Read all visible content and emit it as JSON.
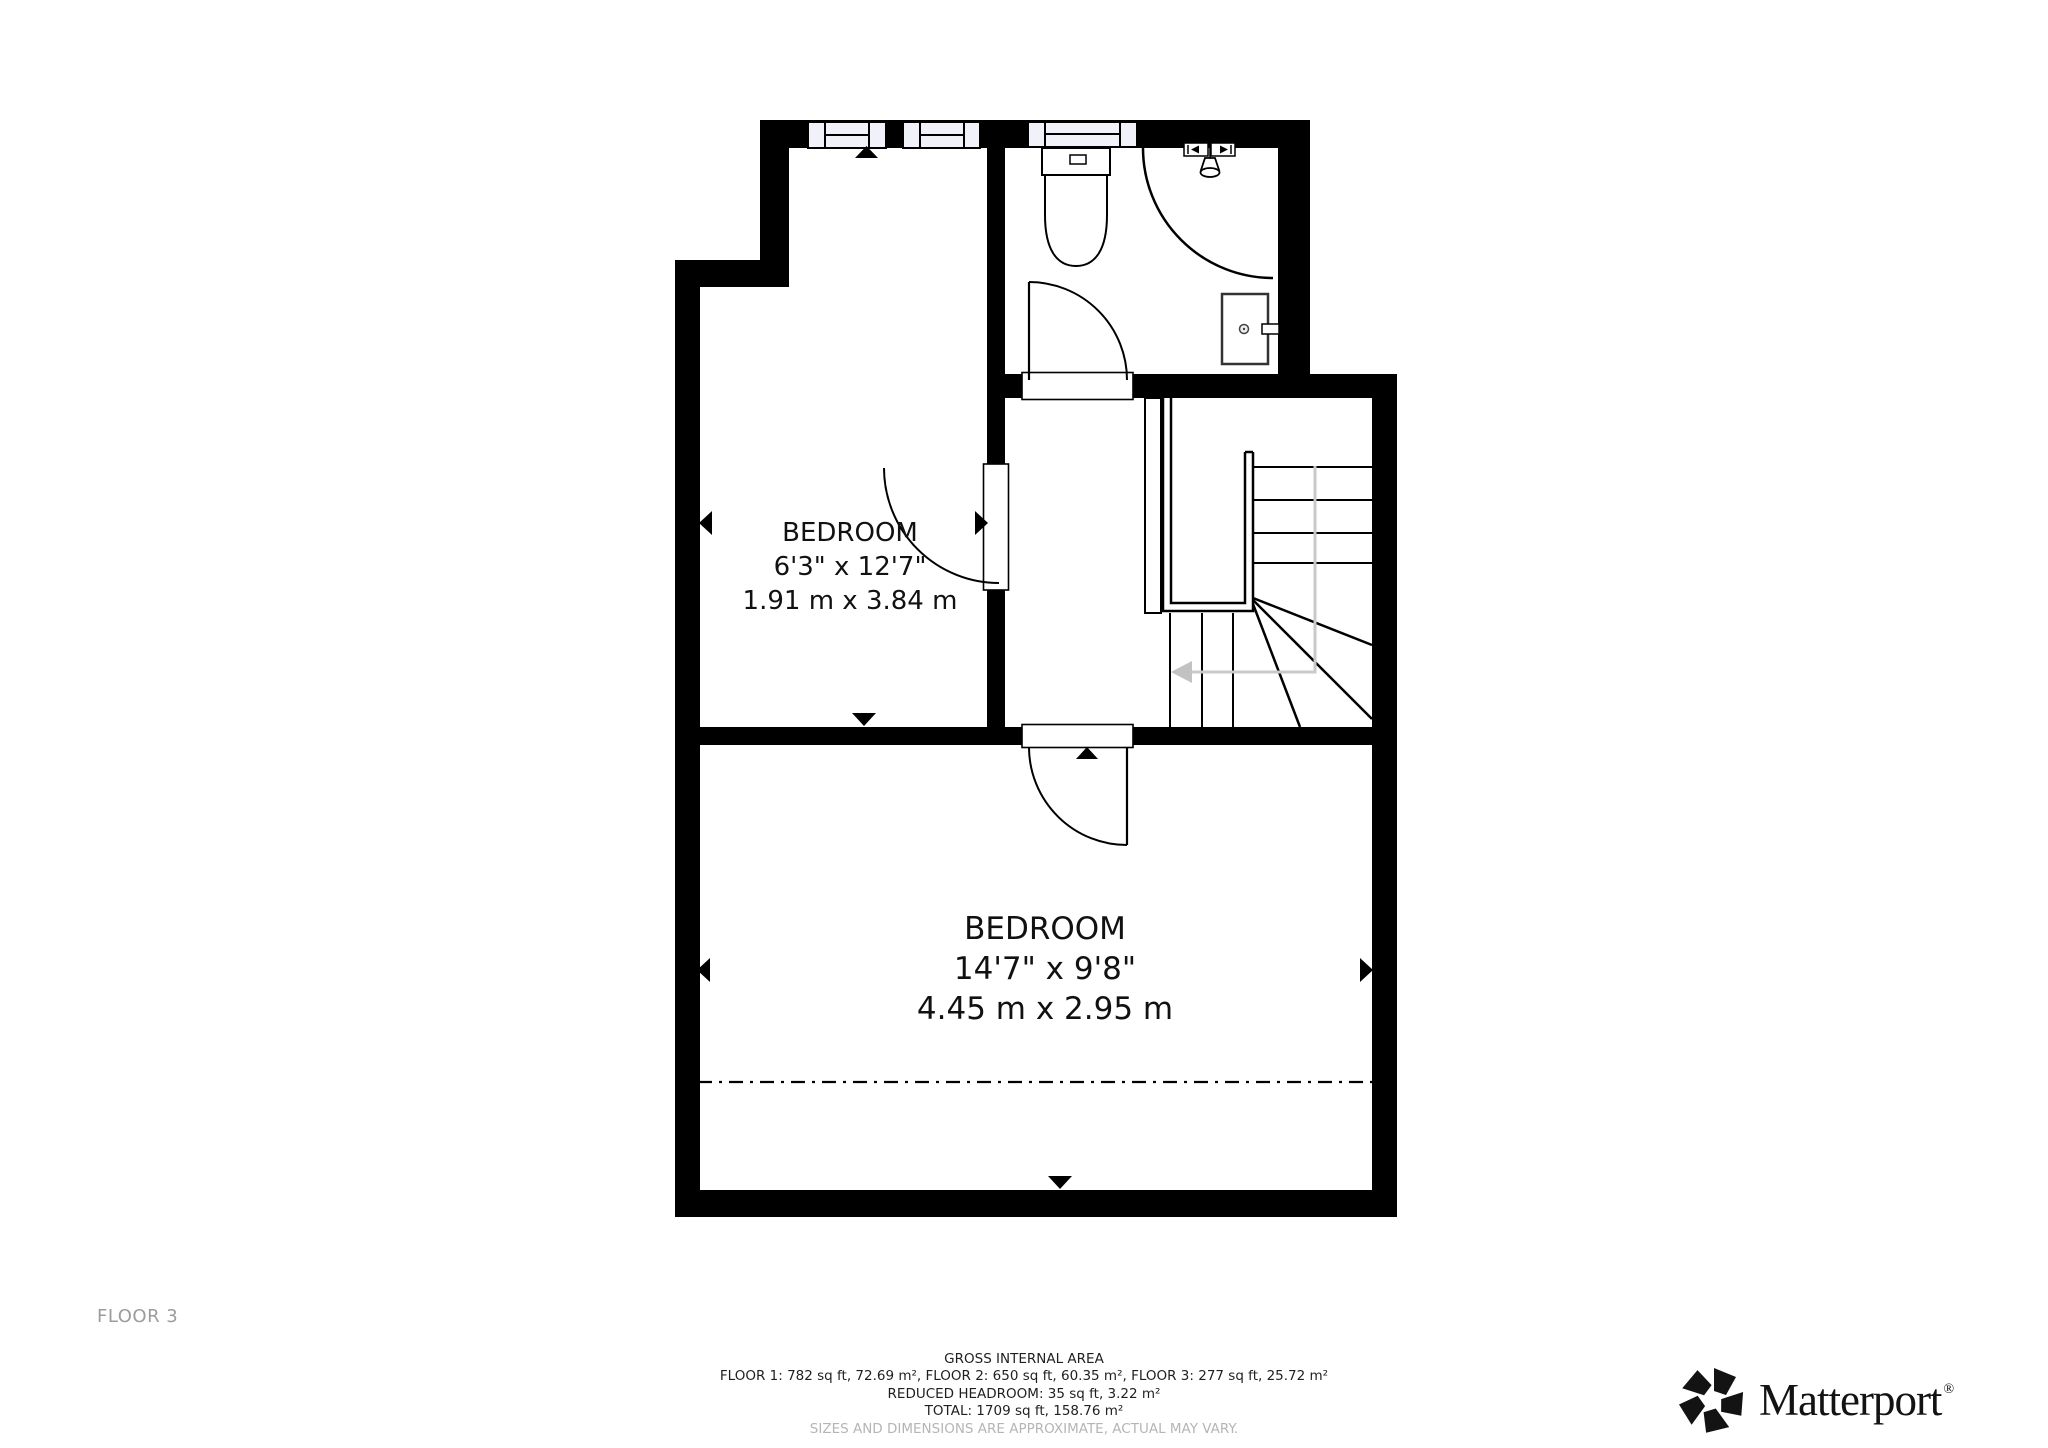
{
  "floor_label": "FLOOR 3",
  "rooms": {
    "bedroom_small": {
      "name": "BEDROOM",
      "dims_imperial": "6'3\" x 12'7\"",
      "dims_metric": "1.91 m x 3.84 m"
    },
    "bedroom_large": {
      "name": "BEDROOM",
      "dims_imperial": "14'7\" x 9'8\"",
      "dims_metric": "4.45 m x 2.95 m"
    }
  },
  "footer": {
    "title": "GROSS INTERNAL AREA",
    "areas_line": "FLOOR 1: 782 sq ft, 72.69 m², FLOOR 2: 650 sq ft, 60.35 m², FLOOR 3: 277 sq ft, 25.72 m²",
    "reduced_line": "REDUCED HEADROOM: 35 sq ft, 3.22 m²",
    "total_line": "TOTAL: 1709 sq ft, 158.76 m²",
    "disclaimer": "SIZES AND DIMENSIONS ARE APPROXIMATE, ACTUAL MAY VARY."
  },
  "brand": {
    "wordmark": "Matterport",
    "registered": "®"
  },
  "colors": {
    "wall": "#000000",
    "window_fill": "#f1f1fa",
    "route_gray": "#c9c9c9",
    "text_dark": "#1f1f1f",
    "text_gray": "#b5b5b5",
    "floor_label_gray": "#9c9c9c"
  }
}
